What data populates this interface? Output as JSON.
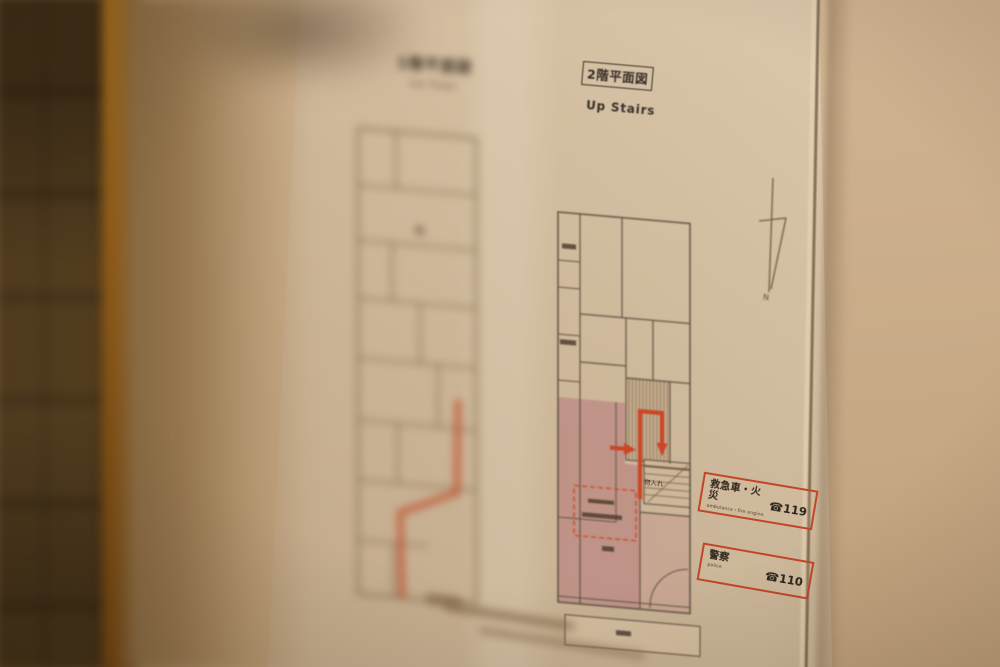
{
  "photo": {
    "setting": "evacuation floor-plan sheet posted on a wall, shallow depth of field",
    "left_plan": {
      "title": "1階平面図",
      "subtitle": "1st Floor"
    },
    "right_plan": {
      "title": "2階平面図",
      "subtitle": "Up Stairs",
      "closet_label": "物入れ"
    },
    "compass": {
      "label": "N"
    },
    "icons": {
      "phone": "☎"
    },
    "emergency": [
      {
        "label": "救急車・火災",
        "sublabel": "ambulance・fire engine",
        "number": "119"
      },
      {
        "label": "警察",
        "sublabel": "police",
        "number": "110"
      }
    ],
    "colors": {
      "route": "#cc4526",
      "box_border": "#c2452a",
      "pink_room": "#bd8b83",
      "ink": "#342c25"
    }
  }
}
